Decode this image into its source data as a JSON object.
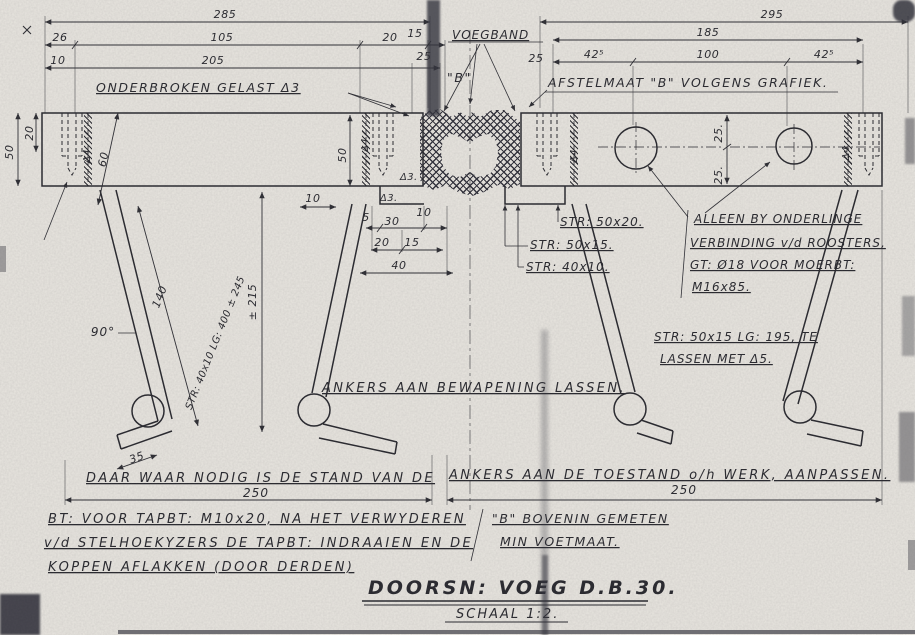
{
  "title": {
    "main": "DOORSN: VOEG D.B.30.",
    "scale": "SCHAAL 1:2."
  },
  "colors": {
    "ink": "#26262c",
    "paper": "#e9e6e0"
  },
  "dims": {
    "d285": "285",
    "d26": "26",
    "d105": "105",
    "d20a": "20",
    "d15a": "15",
    "d10a": "10",
    "d205": "205",
    "d25a": "25",
    "d295": "295",
    "d185": "185",
    "d42a": "42⁵",
    "d100": "100",
    "d42b": "42⁵",
    "d25mid": "25",
    "v50": "50",
    "v20": "20",
    "v60": "60",
    "v50b": "50",
    "s10": "10",
    "s5": "5",
    "s30": "30",
    "s10b": "10",
    "s20": "20",
    "s15": "15",
    "s40": "40",
    "c25a": "25.",
    "c25b": "25.",
    "a140": "140",
    "a215": "± 215",
    "a90": "90°",
    "a35": "35",
    "b250a": "250",
    "b250b": "250"
  },
  "welds": {
    "d3a": "Δ3.",
    "d3b": "Δ3.",
    "d4a": "Δ4",
    "d4b": "Δ4",
    "d4c": "Δ4",
    "d4d": "Δ4"
  },
  "notes": {
    "onderbroken": "ONDERBROKEN GELAST Δ3",
    "voegband": "VOEGBAND",
    "bq": "\"B\"",
    "afstel": "AFSTELMAAT \"B\" VOLGENS GRAFIEK.",
    "str5020": "STR: 50x20.",
    "str5015": "STR: 50x15.",
    "str4010": "STR: 40x10.",
    "alleen1": "ALLEEN BY ONDERLINGE",
    "alleen2": "VERBINDING v/d ROOSTERS,",
    "alleen3": "GT: Ø18 VOOR MOERBT:",
    "alleen4": "M16x85.",
    "strlg1": "STR: 50x15 LG: 195, TE",
    "strlg2": "LASSEN MET Δ5.",
    "ankers": "ANKERS AAN BEWAPENING LASSEN.",
    "aspec": "STR: 40x10 LG: 400 ± 245",
    "daar1": "DAAR WAAR NODIG IS DE STAND VAN DE",
    "daar2": "ANKERS AAN DE TOESTAND o/h WERK, AANPASSEN.",
    "bt1": "BT: VOOR TAPBT: M10x20, NA HET VERWYDEREN",
    "bt2": "v/d STELHOEKYZERS DE TAPBT: INDRAAIEN EN DE",
    "bt3": "KOPPEN AFLAKKEN (DOOR DERDEN)",
    "bm1": "\"B\" BOVENIN GEMETEN",
    "bm2": "MIN VOETMAAT."
  }
}
